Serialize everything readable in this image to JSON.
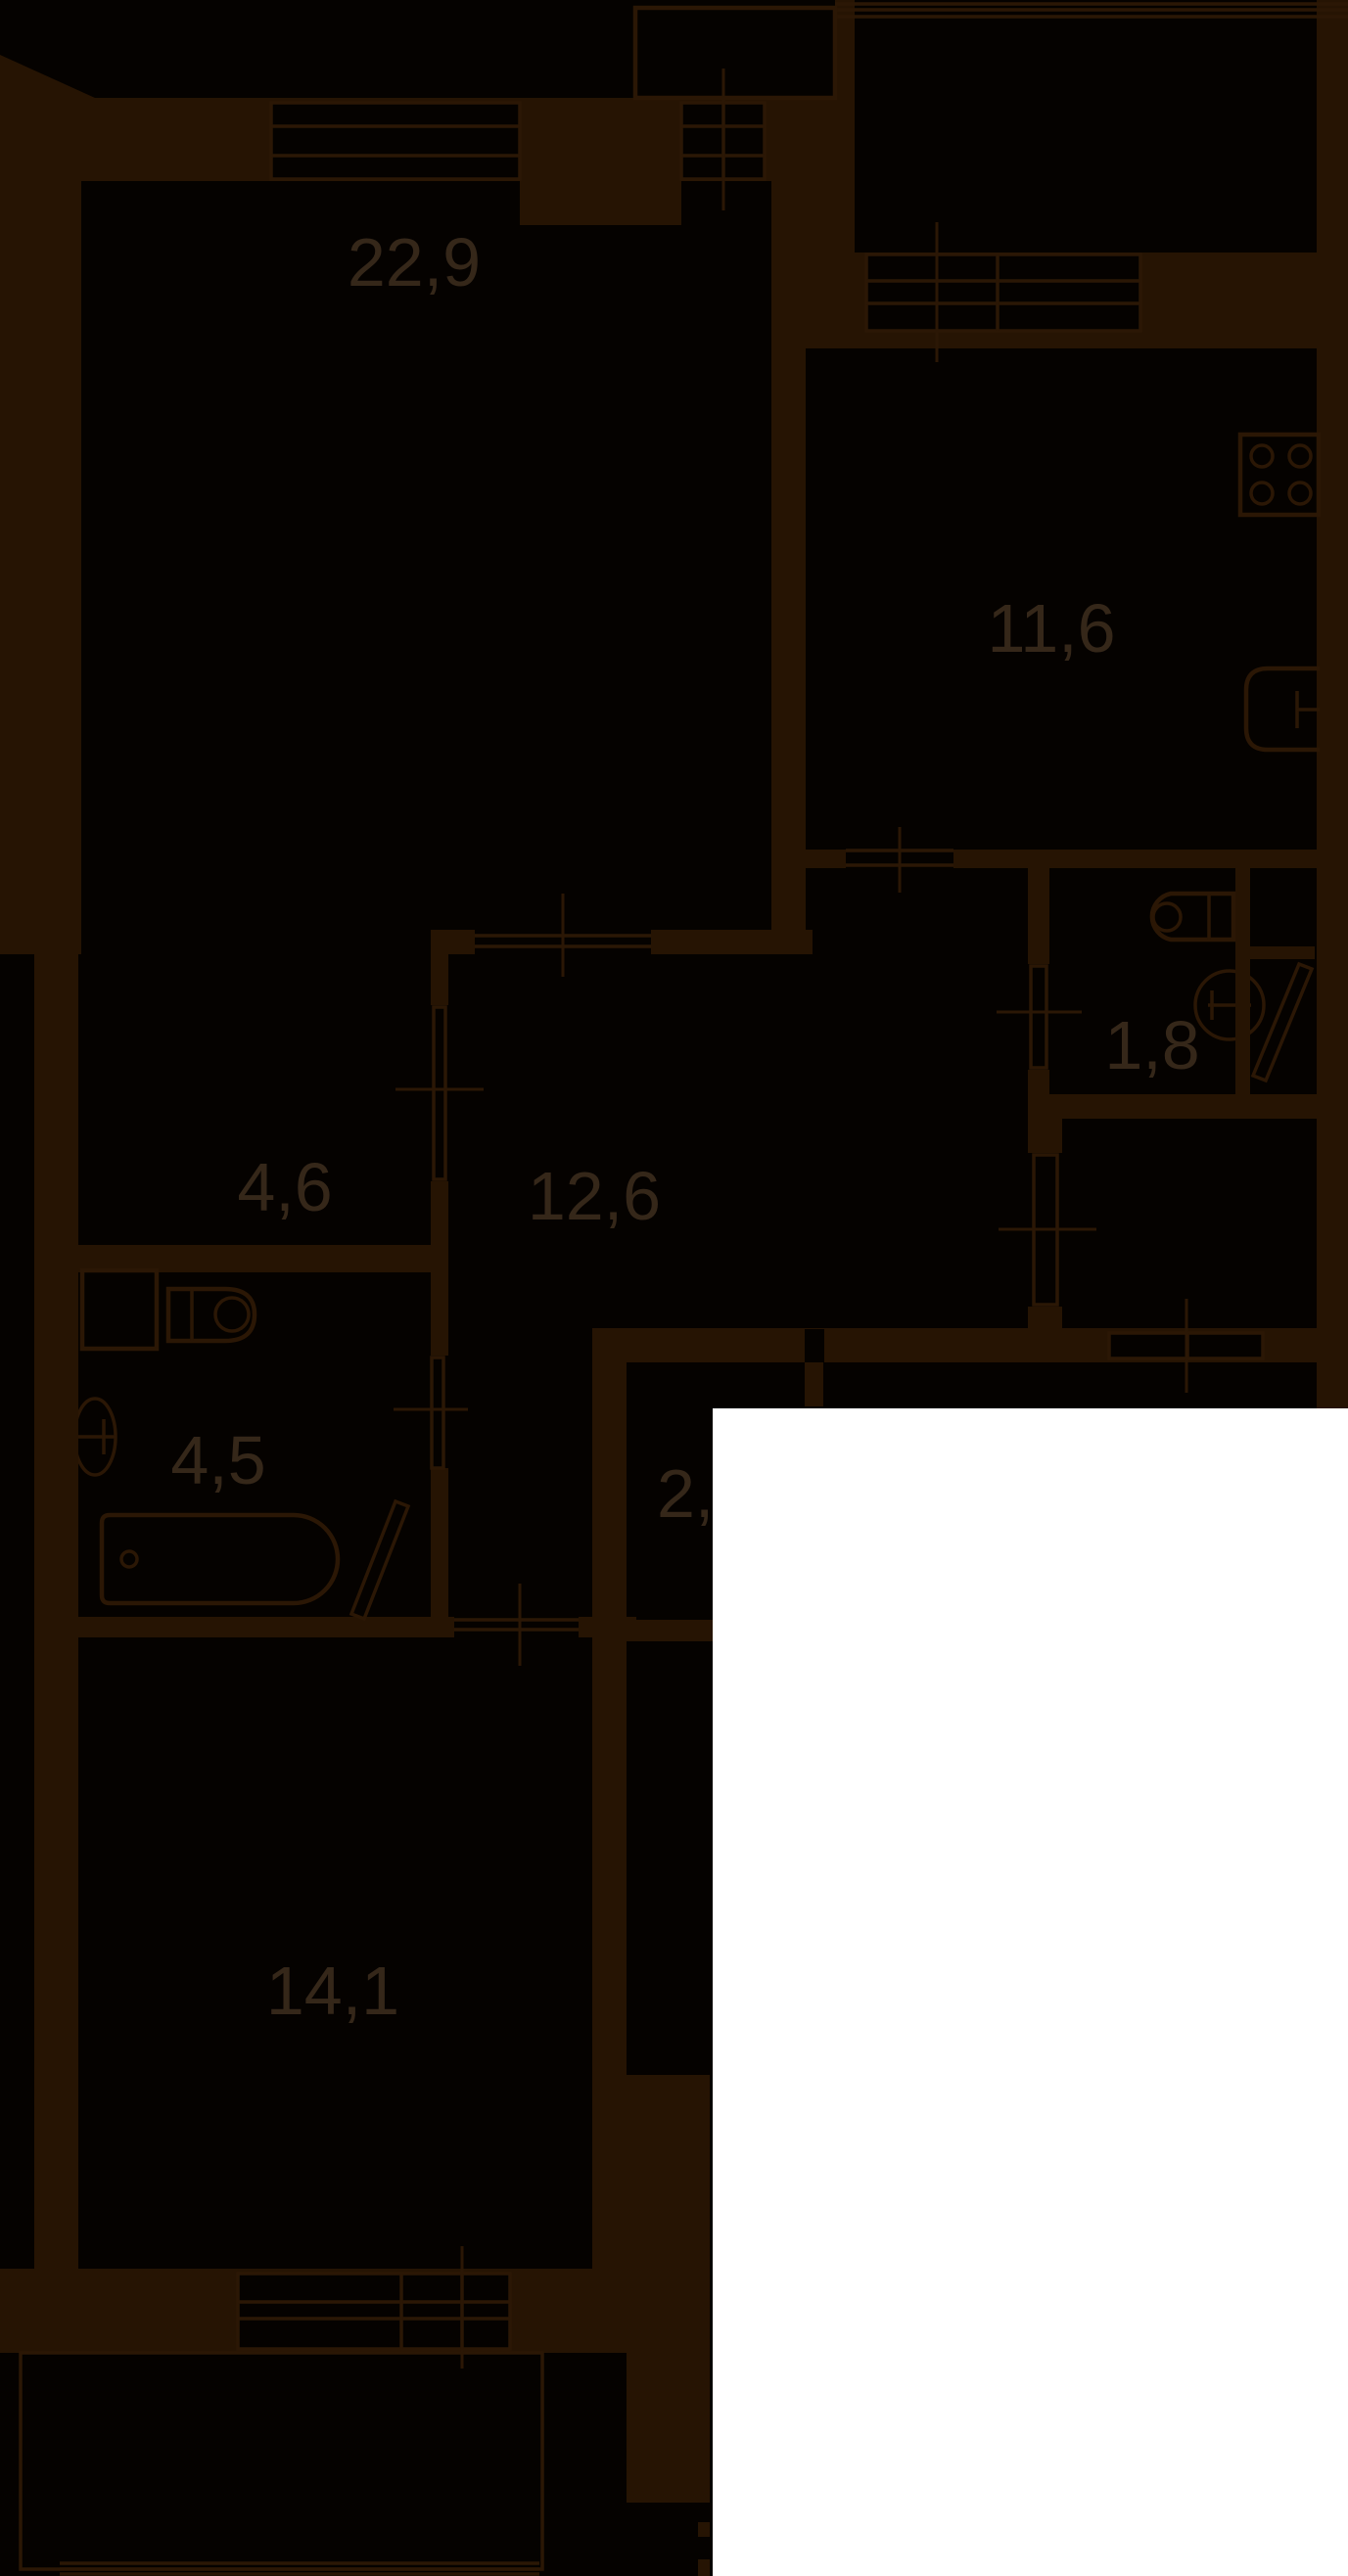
{
  "document": {
    "kind": "apartment-floor-plan",
    "theme": "dark"
  },
  "colors": {
    "background": "#050200",
    "wall": "#261403",
    "line": "#2B1705",
    "label": "#352719",
    "overlay": "#FFFFFF"
  },
  "rooms": [
    {
      "id": "living-room",
      "area": "22,9"
    },
    {
      "id": "kitchen",
      "area": "11,6"
    },
    {
      "id": "wc",
      "area": "1,8"
    },
    {
      "id": "hall",
      "area": "4,6"
    },
    {
      "id": "corridor",
      "area": "12,6"
    },
    {
      "id": "bathroom",
      "area": "4,5"
    },
    {
      "id": "closet",
      "area": "2,"
    },
    {
      "id": "bedroom",
      "area": "14,1"
    }
  ],
  "fixtures": [
    "stove-icon",
    "kitchen-sink-icon",
    "toilet-icon",
    "wc-basin-icon",
    "bath-basin-icon",
    "bath-sink-icon",
    "bathtub-icon",
    "duct-shaft-icon",
    "door-leaf-icon",
    "door-leaf-icon"
  ],
  "overlay_color": "#FFFFFF"
}
